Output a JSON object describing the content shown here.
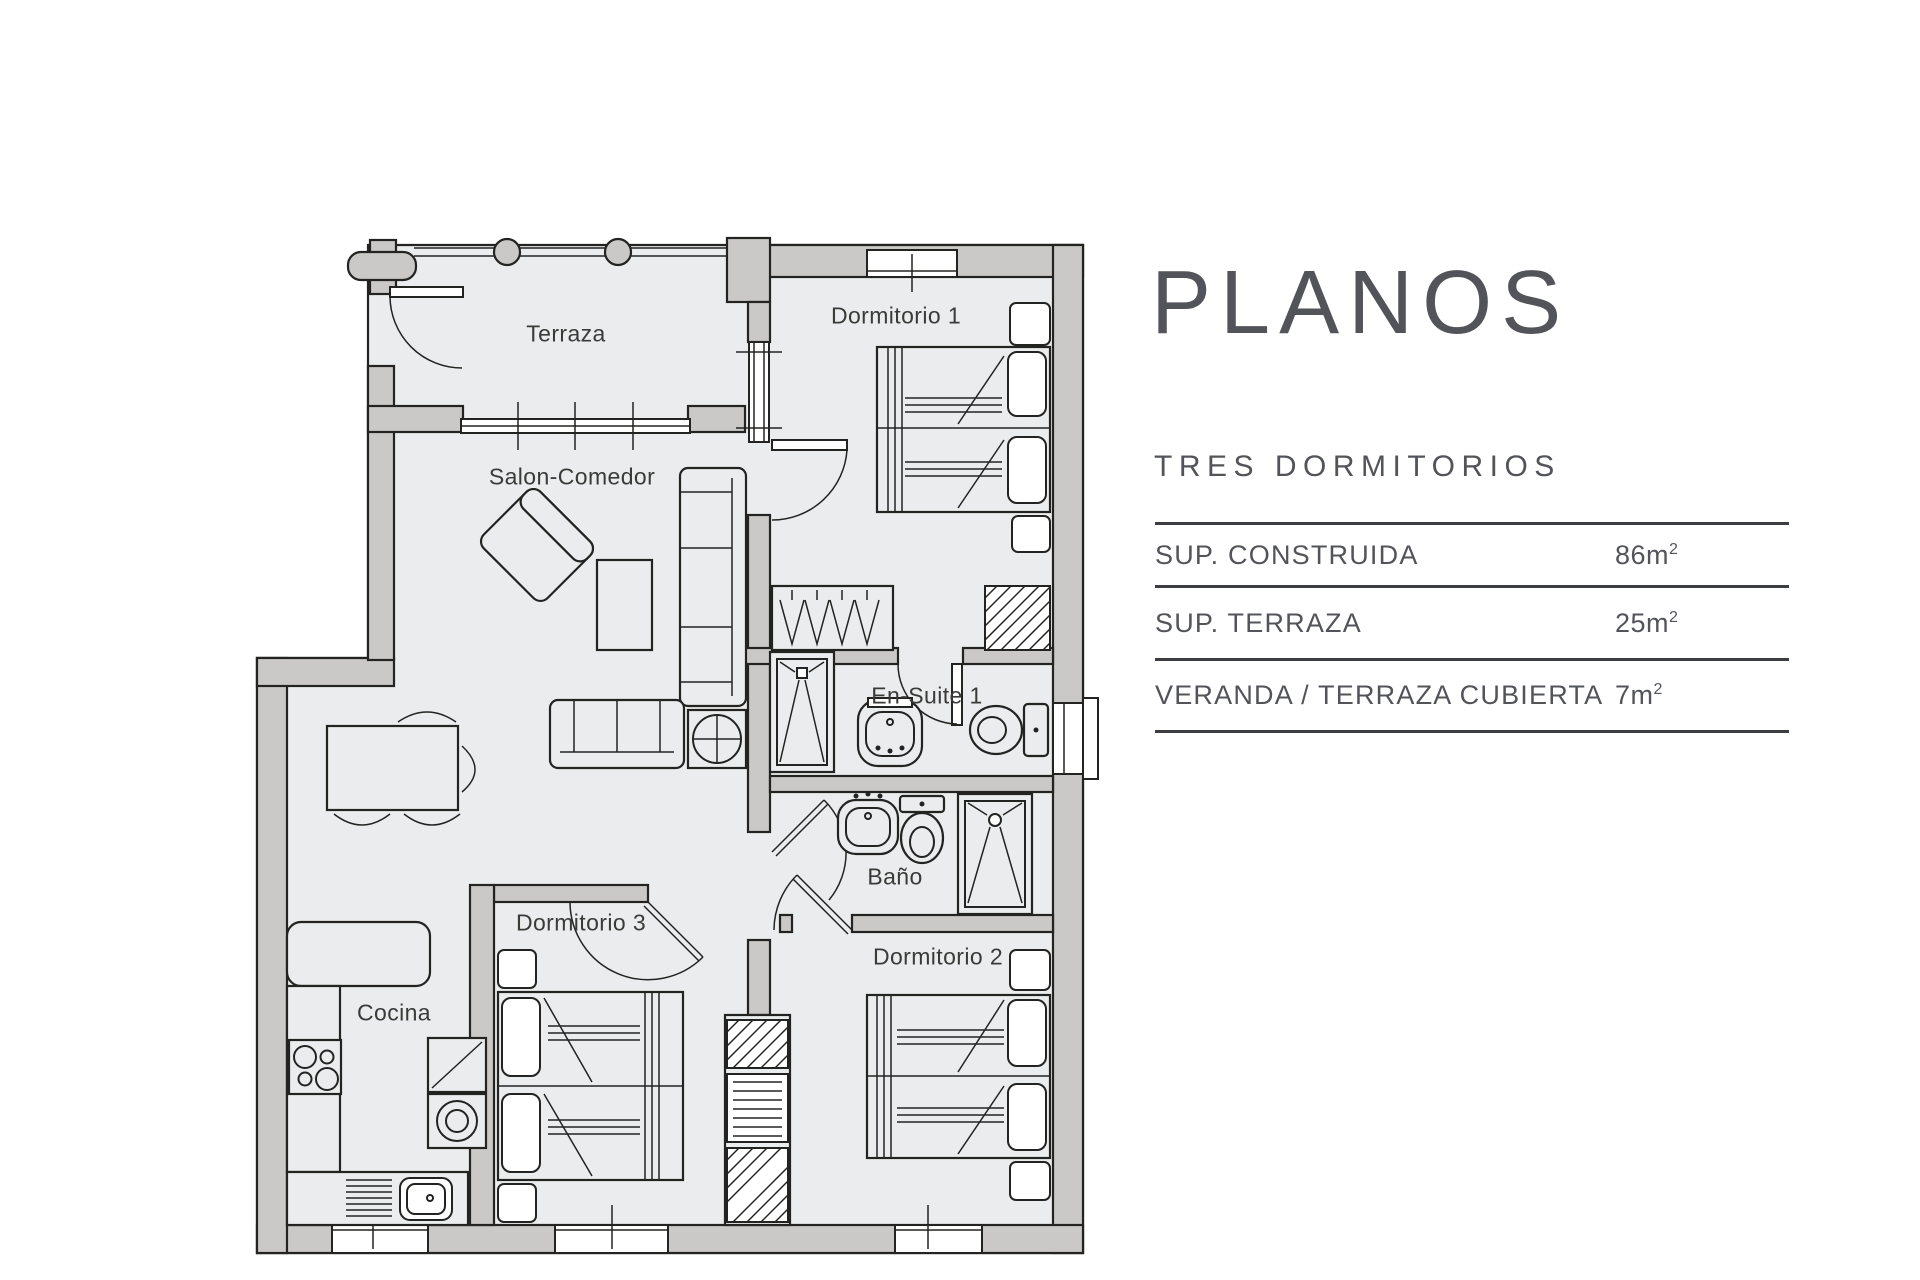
{
  "colors": {
    "wall": "#cac9c7",
    "floor": "#ebeced",
    "line": "#232321",
    "label_text": "#3a3a38",
    "panel_text": "#53545a",
    "table_line": "#3c3d41"
  },
  "panel": {
    "title": "PLANOS",
    "subtitle": "TRES DORMITORIOS",
    "table": {
      "rows": [
        {
          "label": "SUP.  CONSTRUIDA",
          "value": "86m",
          "sup": "2"
        },
        {
          "label": "SUP. TERRAZA",
          "value": "25m",
          "sup": "2"
        },
        {
          "label": "VERANDA / TERRAZA CUBIERTA",
          "value": "7m",
          "sup": "2"
        }
      ]
    }
  },
  "floorplan": {
    "rooms": [
      {
        "id": "terraza",
        "label": "Terraza"
      },
      {
        "id": "dormitorio-1",
        "label": "Dormitorio 1"
      },
      {
        "id": "salon-comedor",
        "label": "Salon-Comedor"
      },
      {
        "id": "en-suite-1",
        "label": "En-Suite 1"
      },
      {
        "id": "bano",
        "label": "Baño"
      },
      {
        "id": "dormitorio-3",
        "label": "Dormitorio 3"
      },
      {
        "id": "dormitorio-2",
        "label": "Dormitorio 2"
      },
      {
        "id": "cocina",
        "label": "Cocina"
      }
    ]
  }
}
